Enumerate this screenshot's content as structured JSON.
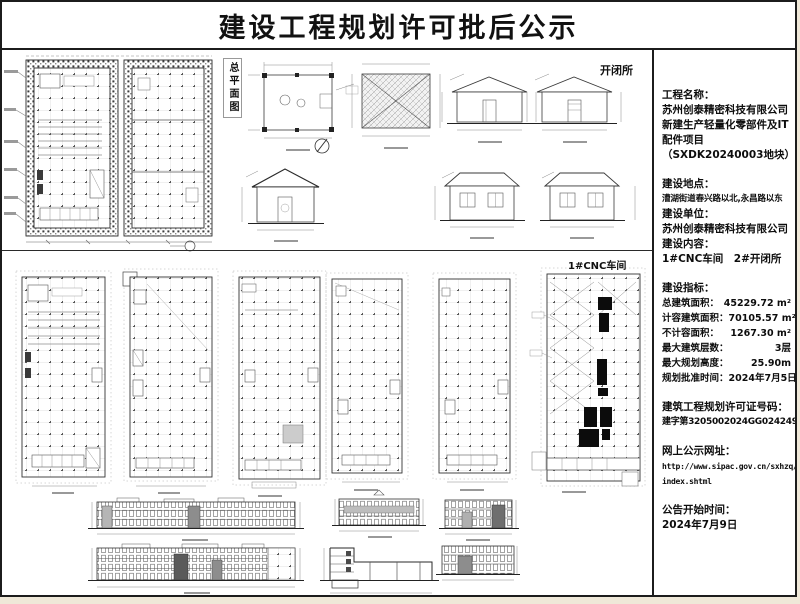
{
  "title": "建设工程规划许可批后公示",
  "drawing_labels": {
    "site_plan": "总平面图",
    "switch_station": "开闭所",
    "cnc_workshop": "1#CNC车间"
  },
  "info": {
    "project_name_label": "工程名称：",
    "project_name_lines": [
      "苏州创泰精密科技有限公司",
      "新建生产轻量化零部件及IT",
      "配件项目",
      "（SXDK20240003地块）"
    ],
    "location_label": "建设地点：",
    "location_value": "漕湖街道春兴路以北,永昌路以东",
    "unit_label": "建设单位：",
    "unit_value": "苏州创泰精密科技有限公司",
    "content_label": "建设内容：",
    "content_value": "1#CNC车间　2#开闭所",
    "indicators_label": "建设指标：",
    "indicators": [
      {
        "label": "总建筑面积：",
        "value": "45229.72 m²"
      },
      {
        "label": "计容建筑面积：",
        "value": "70105.57 m²"
      },
      {
        "label": "不计容面积：",
        "value": "1267.30 m²"
      },
      {
        "label": "最大建筑层数：",
        "value": "3层"
      },
      {
        "label": "最大规划高度：",
        "value": "25.90m"
      },
      {
        "label": "规划批准时间：",
        "value": "2024年7月5日"
      }
    ],
    "permit_label": "建筑工程规划许可证号码：",
    "permit_value": "建字第3205002024GG0242497号",
    "website_label": "网上公示网址：",
    "website_lines": [
      "http://www.sipac.gov.cn/sxhzq/",
      "index.shtml"
    ],
    "announce_label": "公告开始时间：",
    "announce_value": "2024年7月9日"
  }
}
